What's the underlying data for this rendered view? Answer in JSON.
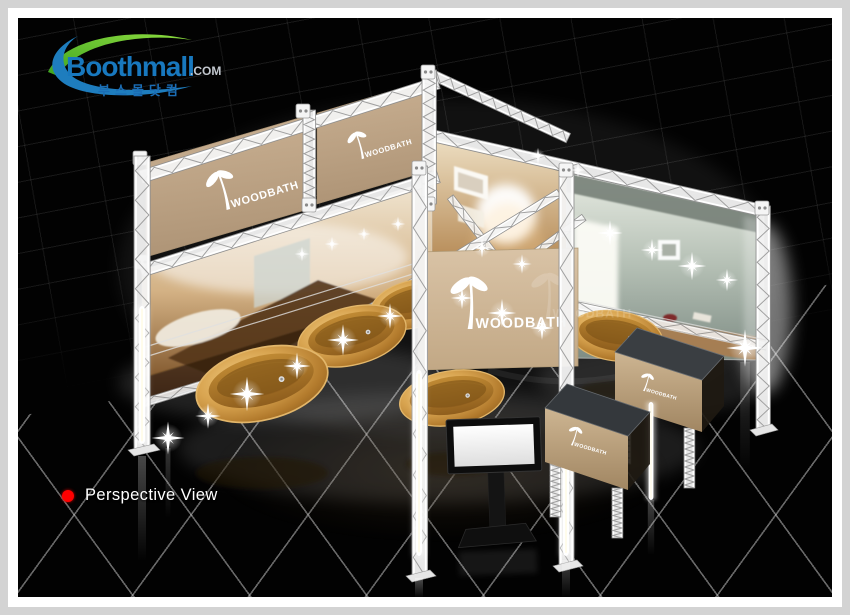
{
  "branding": {
    "logo_text": "Boothmall",
    "logo_suffix": ".COM",
    "logo_korean": "부스몰닷컴",
    "colors": {
      "logo_blue": "#1878be",
      "logo_green": "#56b531",
      "suffix_gray": "#c2c7ce"
    }
  },
  "caption": {
    "text": "Perspective View",
    "bullet_color": "#fe0000",
    "text_color": "#ffffff"
  },
  "booth": {
    "brand_name": "WOODBATH",
    "banner_color": "#c0a685",
    "sign_color": "#cdb596",
    "counter_top_color": "#34383c",
    "counter_front_color": "#c2a987",
    "truss_color": "#f0f0f0",
    "tub_wood_color": "#c8913f"
  },
  "frame": {
    "outer_color": "#d3d3d3",
    "inner_color": "#ffffff",
    "canvas_color": "#020202",
    "floor_grid_color": "#cdcdcd"
  }
}
